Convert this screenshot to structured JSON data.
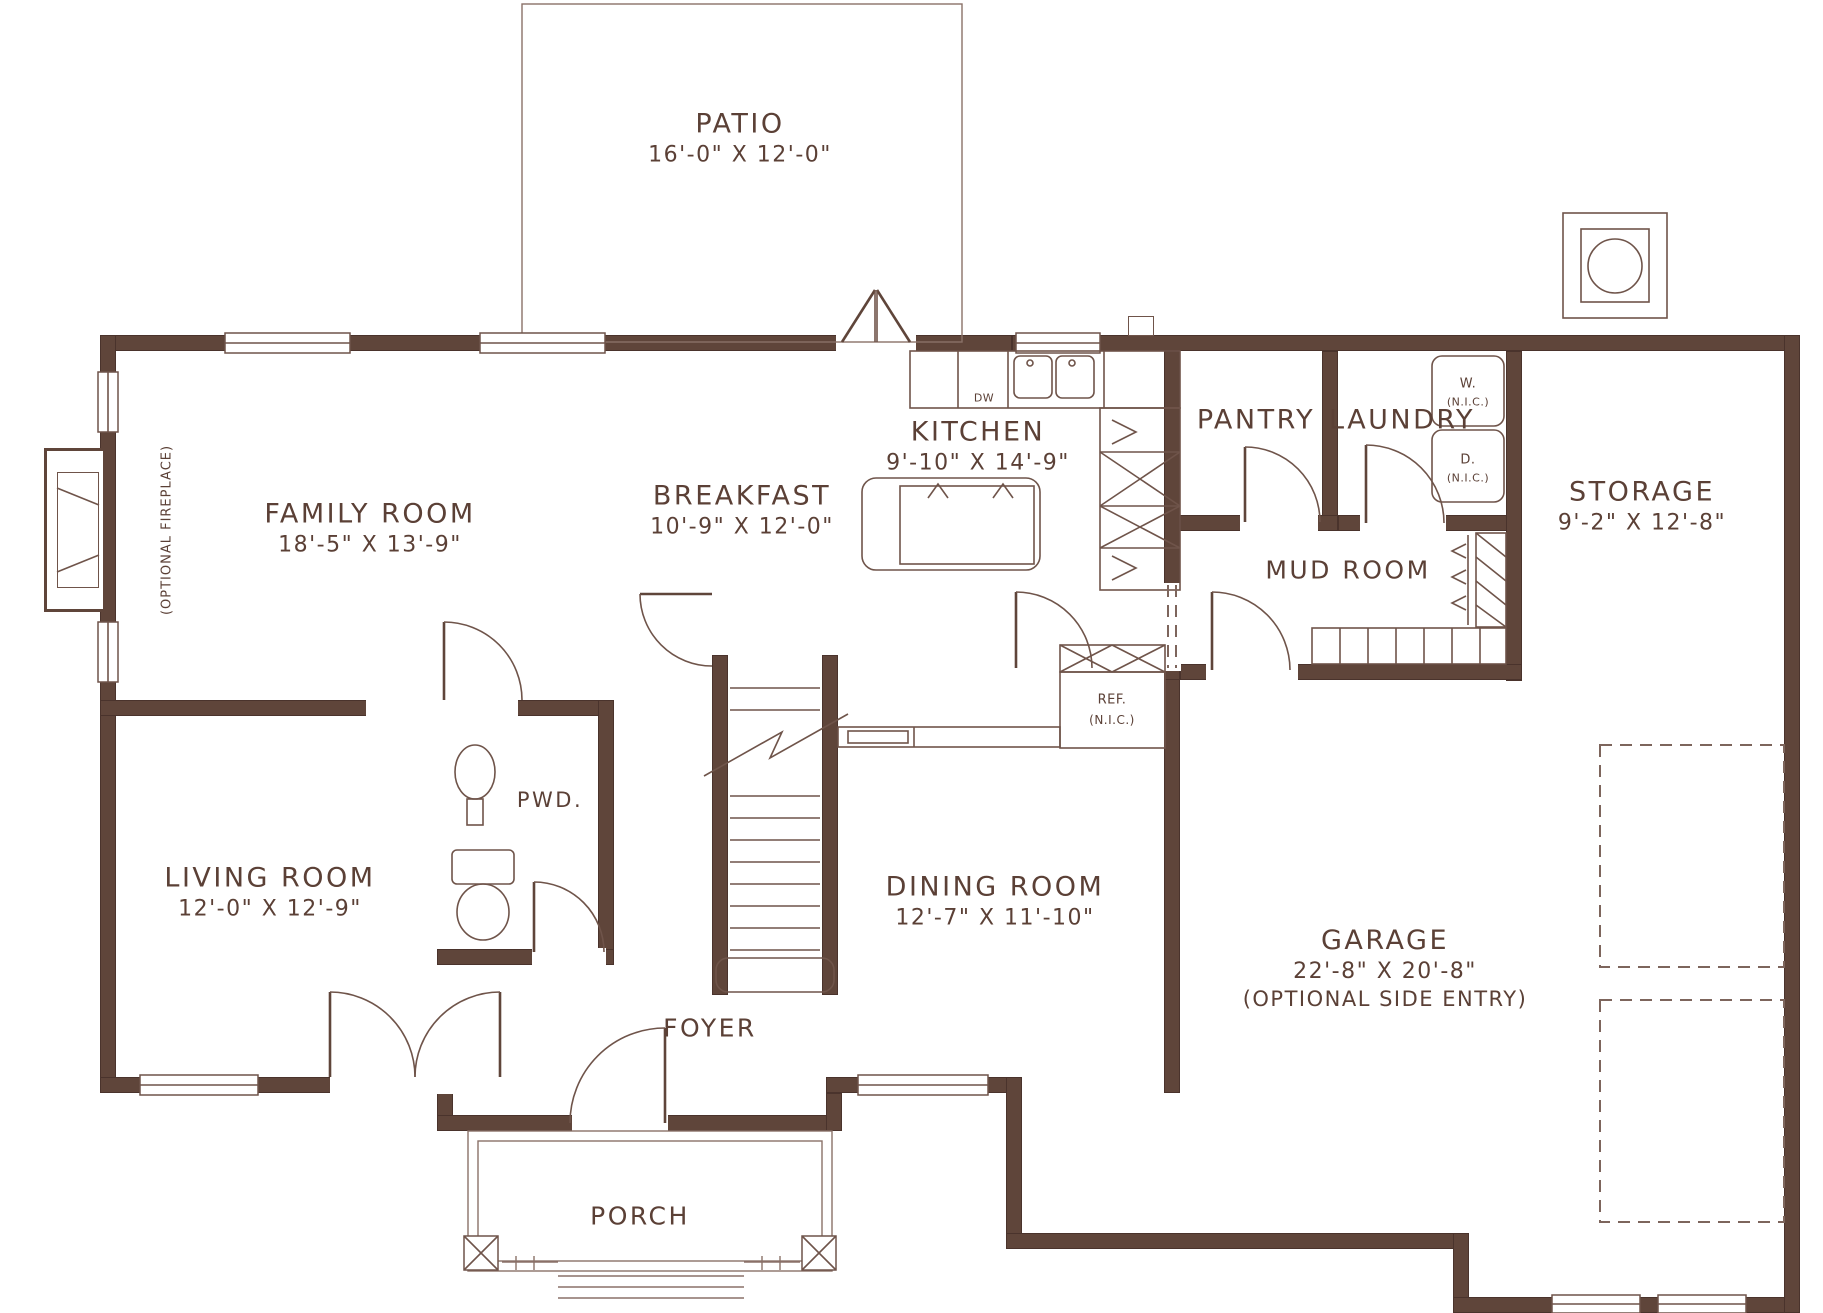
{
  "plan": {
    "rooms": [
      {
        "id": "patio",
        "label": "PATIO",
        "dims": "16'-0\" X 12'-0\""
      },
      {
        "id": "family",
        "label": "FAMILY ROOM",
        "dims": "18'-5\" X 13'-9\""
      },
      {
        "id": "breakfast",
        "label": "BREAKFAST",
        "dims": "10'-9\" X 12'-0\""
      },
      {
        "id": "kitchen",
        "label": "KITCHEN",
        "dims": "9'-10\" X 14'-9\""
      },
      {
        "id": "pantry",
        "label": "PANTRY",
        "dims": ""
      },
      {
        "id": "laundry",
        "label": "LAUNDRY",
        "dims": ""
      },
      {
        "id": "storage",
        "label": "STORAGE",
        "dims": "9'-2\" X 12'-8\""
      },
      {
        "id": "mudroom",
        "label": "MUD ROOM",
        "dims": ""
      },
      {
        "id": "living",
        "label": "LIVING ROOM",
        "dims": "12'-0\" X 12'-9\""
      },
      {
        "id": "pwd",
        "label": "PWD.",
        "dims": ""
      },
      {
        "id": "dining",
        "label": "DINING ROOM",
        "dims": "12'-7\" X 11'-10\""
      },
      {
        "id": "garage",
        "label": "GARAGE",
        "dims": "22'-8\" X 20'-8\"",
        "note": "(OPTIONAL SIDE ENTRY)"
      },
      {
        "id": "foyer",
        "label": "FOYER",
        "dims": ""
      },
      {
        "id": "porch",
        "label": "PORCH",
        "dims": ""
      }
    ],
    "fixtures": {
      "fireplace_note": "(OPTIONAL FIREPLACE)",
      "washer": "W.",
      "dryer": "D.",
      "fridge": "REF.",
      "nic_note": "(N.I.C.)",
      "dishwasher": "DW"
    },
    "colors": {
      "wall": "#5f453a",
      "line": "#6f544a",
      "light_line": "#8a7168",
      "text": "#5b4036"
    }
  }
}
